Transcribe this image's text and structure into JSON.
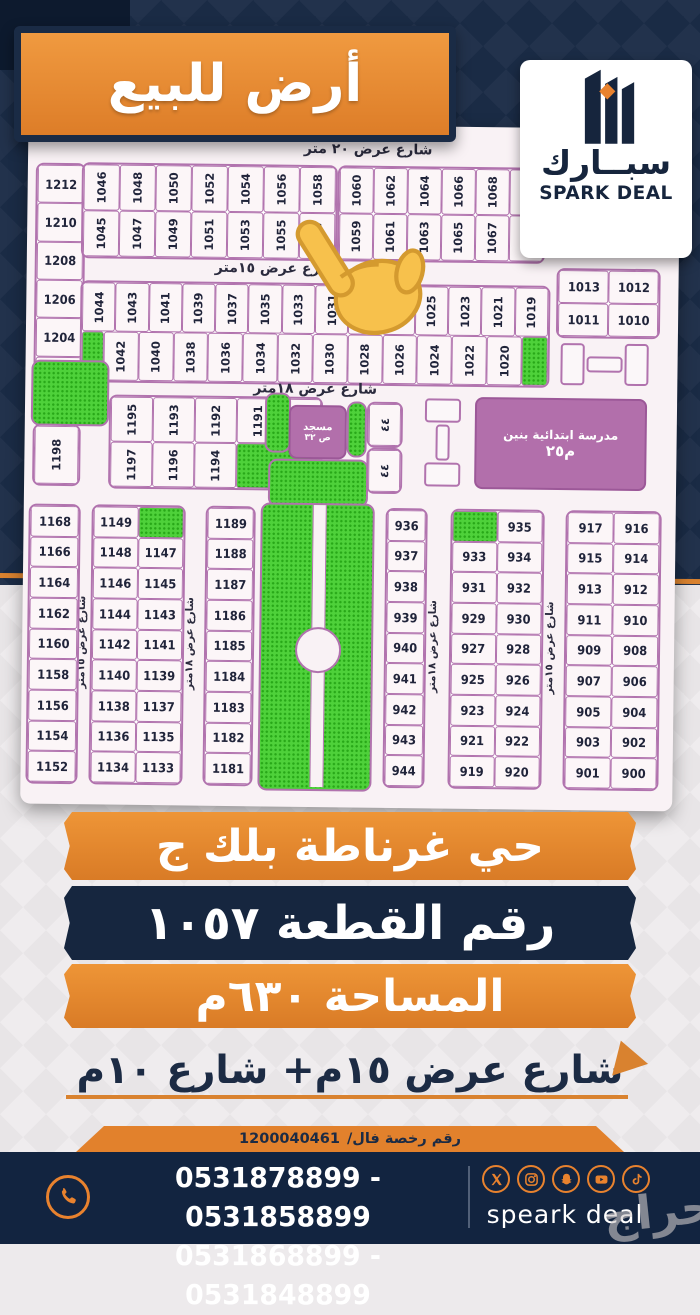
{
  "title_banner": {
    "text": "أرض للبيع"
  },
  "logo": {
    "arabic": "سبــارك",
    "english": "SPARK DEAL"
  },
  "map": {
    "streets": {
      "top20": "شارع عرض ٢٠ متر",
      "h15": "شارع عرض ١٥متر",
      "h18": "شارع عرض ١٨متر",
      "v15": "شارع عرض ١٥متر",
      "v18": "شارع عرض ١٨متر"
    },
    "landmarks": {
      "mosque_line1": "مسجد",
      "mosque_line2": "ص ٣٢",
      "school_line1": "مدرسة ابتدائية بنين",
      "school_line2": "م٢٥",
      "small_cell_label": "٤٤"
    },
    "left_strip_top": [
      "1212",
      "1210",
      "1208",
      "1206",
      "1204",
      "1202"
    ],
    "row_a1": [
      "1046",
      "1048",
      "1050",
      "1052",
      "1054",
      "1056",
      "1058"
    ],
    "row_a2": [
      "1045",
      "1047",
      "1049",
      "1051",
      "1053",
      "1055",
      "1057"
    ],
    "row_b1": [
      "1060",
      "1062",
      "1064",
      "1066",
      "1068",
      "1070"
    ],
    "row_b2": [
      "1059",
      "1061",
      "1063",
      "1065",
      "1067",
      "1069"
    ],
    "corner_block": [
      [
        "1013",
        "1012"
      ],
      [
        "1011",
        "1010"
      ]
    ],
    "row_c1": [
      "1044",
      "1043",
      "1041",
      "1039",
      "1037",
      "1035",
      "1033",
      "1031",
      "1029",
      "1027",
      "1025",
      "1023",
      "1021",
      "1019"
    ],
    "row_c2": [
      "1042",
      "1040",
      "1038",
      "1036",
      "1034",
      "1032",
      "1030",
      "1028",
      "1026",
      "1024",
      "1022",
      "1020"
    ],
    "block_d_top": [
      "1195",
      "1193",
      "1192",
      "1191",
      "1190"
    ],
    "block_d_bottom": [
      "1197",
      "1196",
      "1194"
    ],
    "cell_1198": "1198",
    "left_strip_bottom": [
      "1168",
      "1166",
      "1164",
      "1162",
      "1160",
      "1158",
      "1156",
      "1154",
      "1152"
    ],
    "col_1149": [
      [
        "1149",
        null
      ],
      [
        "1148",
        "1147"
      ],
      [
        "1146",
        "1145"
      ],
      [
        "1144",
        "1143"
      ],
      [
        "1142",
        "1141"
      ],
      [
        "1140",
        "1139"
      ],
      [
        "1138",
        "1137"
      ],
      [
        "1136",
        "1135"
      ],
      [
        "1134",
        "1133"
      ]
    ],
    "col_1189": [
      "1189",
      "1188",
      "1187",
      "1186",
      "1185",
      "1184",
      "1183",
      "1182",
      "1181"
    ],
    "col_936": [
      "936",
      "937",
      "938",
      "939",
      "940",
      "941",
      "942",
      "943",
      "944"
    ],
    "col_933": [
      [
        null,
        "935"
      ],
      [
        "933",
        "934"
      ],
      [
        "931",
        "932"
      ],
      [
        "929",
        "930"
      ],
      [
        "927",
        "928"
      ],
      [
        "925",
        "926"
      ],
      [
        "923",
        "924"
      ],
      [
        "921",
        "922"
      ],
      [
        "919",
        "920"
      ]
    ],
    "col_917": [
      [
        "917",
        "916"
      ],
      [
        "915",
        "914"
      ],
      [
        "913",
        "912"
      ],
      [
        "911",
        "910"
      ],
      [
        "909",
        "908"
      ],
      [
        "907",
        "906"
      ],
      [
        "905",
        "904"
      ],
      [
        "903",
        "902"
      ],
      [
        "901",
        "900"
      ]
    ],
    "highlighted_plot": "1057"
  },
  "info_banners": [
    {
      "text": "حي غرناطة بلك ج"
    },
    {
      "text": "رقم القطعة ١٠٥٧"
    },
    {
      "text": "المساحة ٦٣٠م"
    }
  ],
  "street_note": "شارع عرض ١٥م+ شارع ١٠م",
  "license": {
    "label": "رقم رخصة فال/",
    "number": "1200040461"
  },
  "footer": {
    "phones_line1": "0531878899 - 0531858899",
    "phones_line2": "0531868899 - 0531848899",
    "brand": "speark deal",
    "social_icons": [
      "x-icon",
      "instagram-icon",
      "snapchat-icon",
      "youtube-icon",
      "tiktok-icon"
    ]
  },
  "watermark": "حراج",
  "colors": {
    "navy": "#1a2b45",
    "orange": "#e2812c",
    "map_purple": "#b173ae",
    "park_green": "#4ed13a"
  }
}
